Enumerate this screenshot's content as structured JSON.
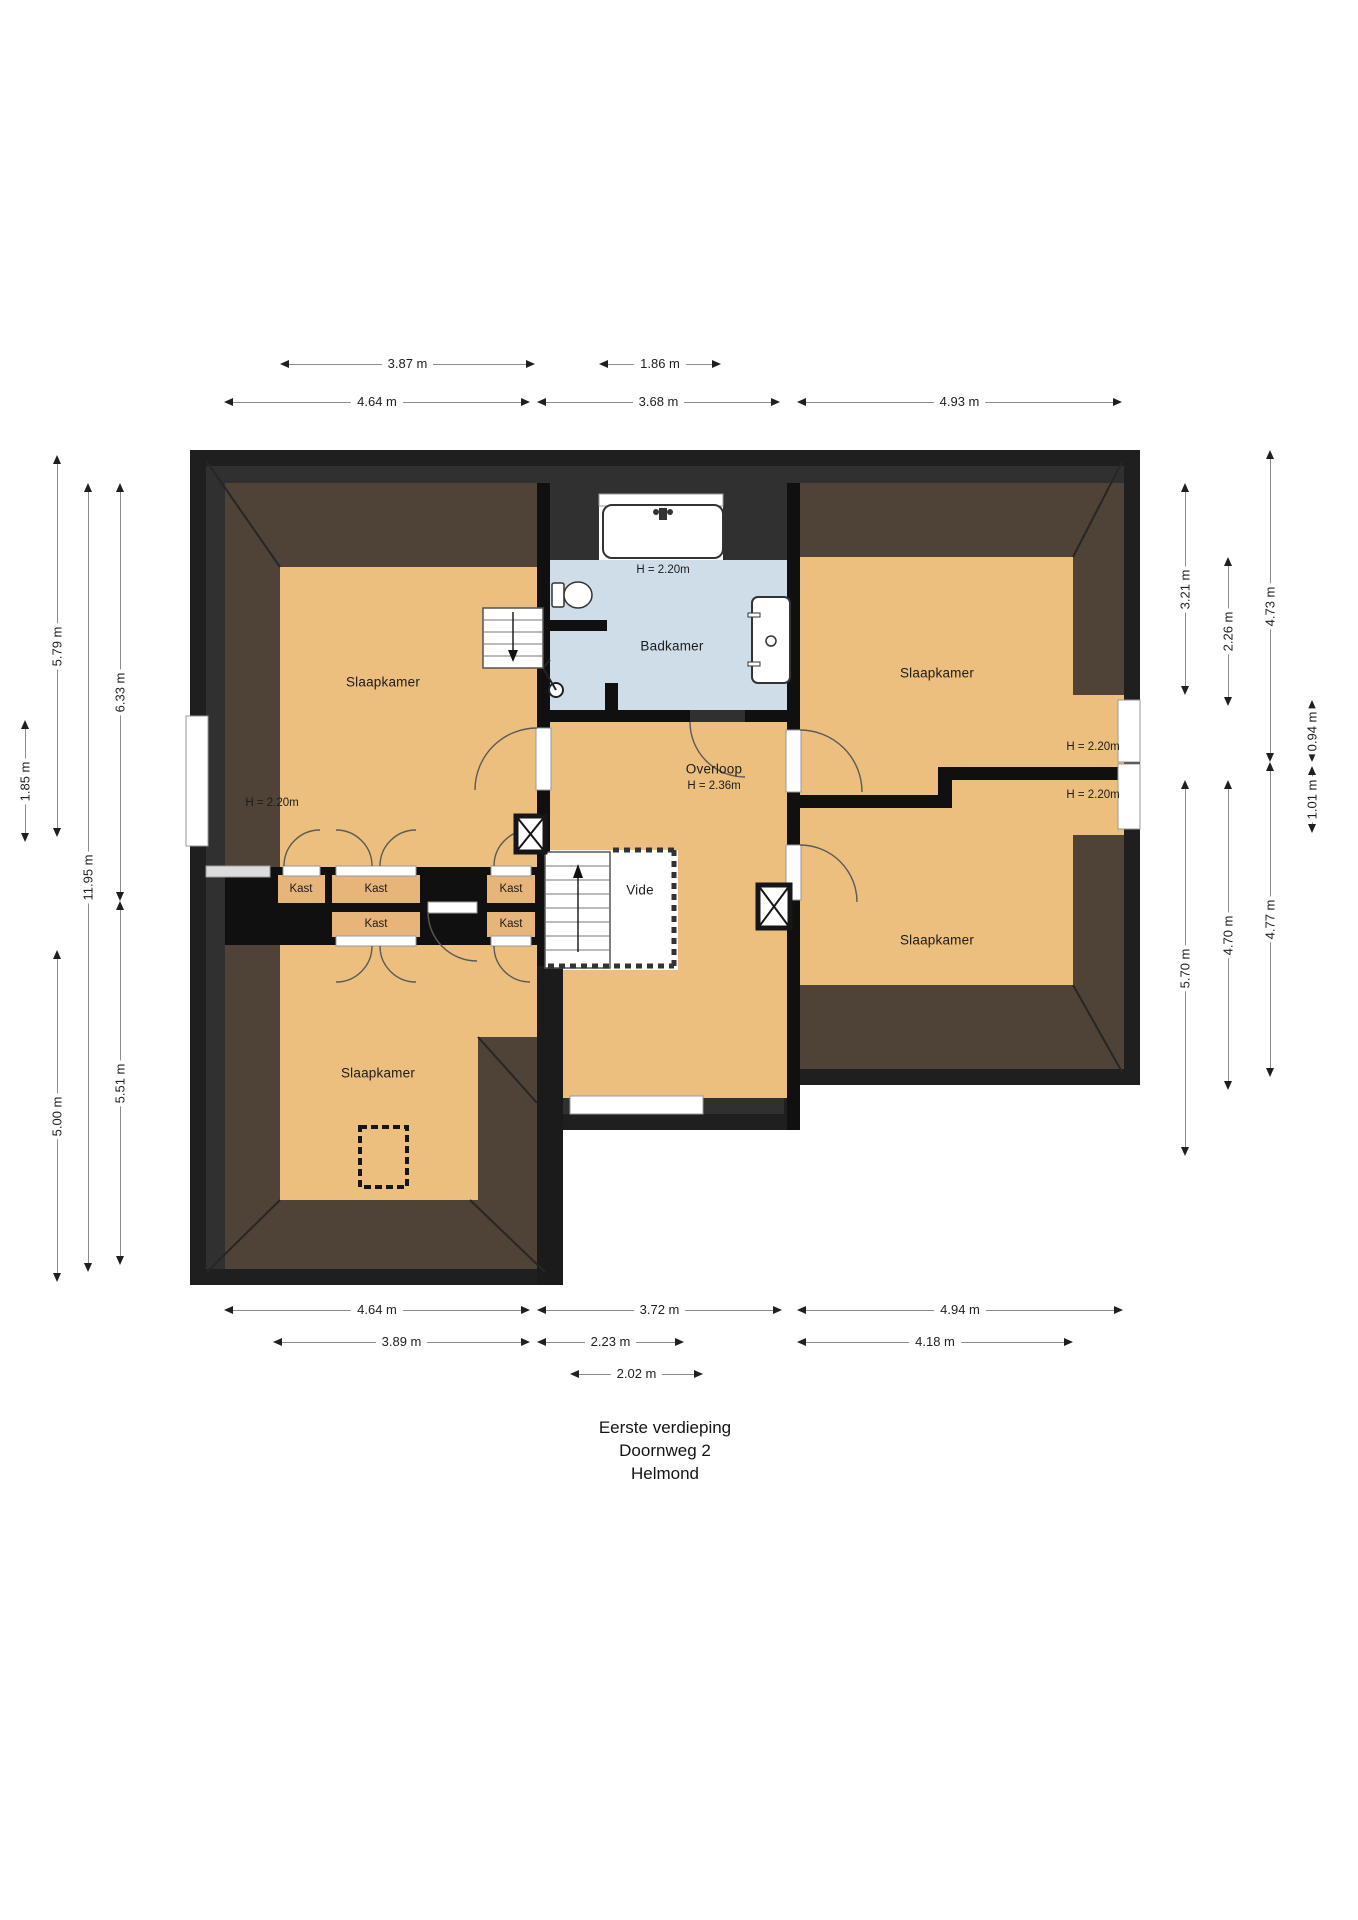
{
  "title": {
    "line1": "Eerste verdieping",
    "line2": "Doornweg 2",
    "line3": "Helmond"
  },
  "rooms": {
    "slaapkamer": "Slaapkamer",
    "badkamer": "Badkamer",
    "overloop": "Overloop",
    "vide": "Vide",
    "kast": "Kast",
    "h220": "H = 2.20m",
    "h236": "H = 2.36m"
  },
  "dimensions": {
    "top": {
      "d387": "3.87 m",
      "d186": "1.86 m",
      "d464": "4.64 m",
      "d368": "3.68 m",
      "d493": "4.93 m"
    },
    "bottom": {
      "d464": "4.64 m",
      "d372": "3.72 m",
      "d494": "4.94 m",
      "d389": "3.89 m",
      "d223": "2.23 m",
      "d418": "4.18 m",
      "d202": "2.02 m"
    },
    "left": {
      "d579": "5.79 m",
      "d500": "5.00 m",
      "d1195": "11.95 m",
      "d633": "6.33 m",
      "d551": "5.51 m",
      "d185": "1.85 m"
    },
    "right": {
      "d321": "3.21 m",
      "d570": "5.70 m",
      "d226": "2.26 m",
      "d470": "4.70 m",
      "d473": "4.73 m",
      "d477": "4.77 m",
      "d094": "0.94 m",
      "d101": "1.01 m"
    }
  },
  "colors": {
    "floor": "#ecbf7e",
    "bathroom_floor": "#cfdde9",
    "attic": "#4e4336",
    "outer_wall": "#1f1f1f",
    "inner_wall_band": "#303030",
    "interior_wall": "#101010"
  }
}
